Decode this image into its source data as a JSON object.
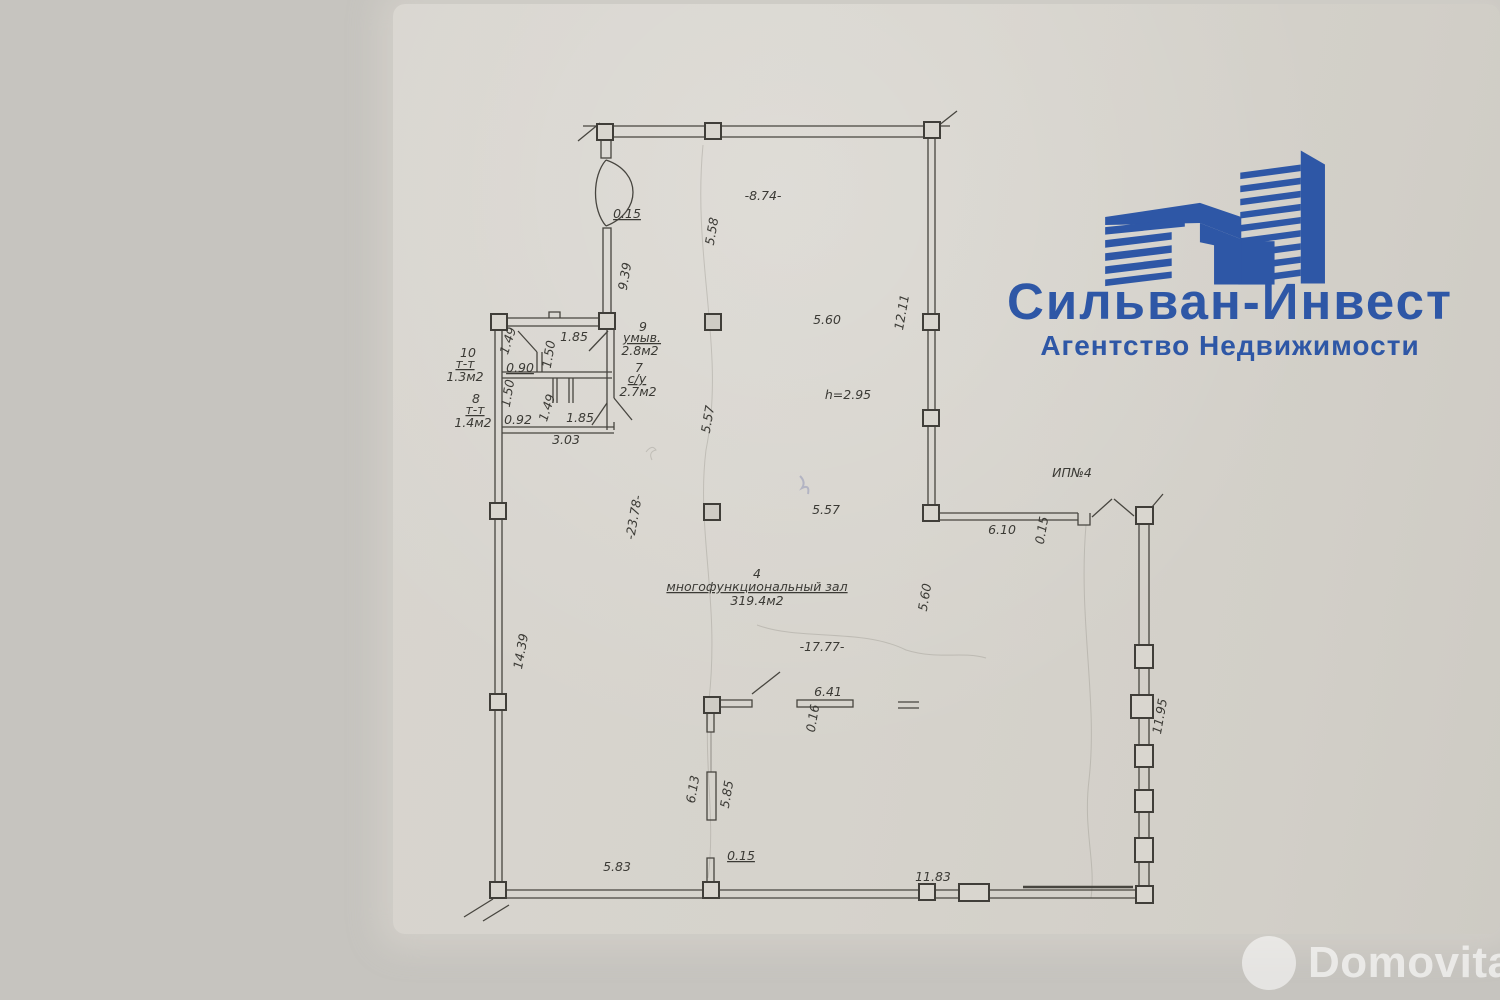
{
  "logo": {
    "title": "Сильван-Инвест",
    "subtitle": "Агентство Недвижимости",
    "color": "#2e57a6"
  },
  "watermark": {
    "text": "Domovita"
  },
  "colors": {
    "background": "#c6c4bf",
    "paper": "#d6d3cc",
    "line": "#47453f",
    "logo_blue": "#2e57a6"
  },
  "plan": {
    "summary": {
      "hall": {
        "number": "4",
        "name": "многофункциональный зал",
        "area": "319.4м2",
        "ceiling_height": "h=2.95"
      },
      "rooms": [
        {
          "number": "7",
          "name": "с/у",
          "area": "2.7м2"
        },
        {
          "number": "8",
          "name": "т-т",
          "area": "1.4м2"
        },
        {
          "number": "9",
          "name": "умыв.",
          "area": "2.8м2"
        },
        {
          "number": "10",
          "name": "т-т",
          "area": "1.3м2"
        }
      ],
      "entrance_label": "ИП№4"
    },
    "labels": [
      {
        "t": "0.15",
        "x": 627,
        "y": 218,
        "u": 1
      },
      {
        "t": "9.39",
        "x": 629,
        "y": 277,
        "r": -80
      },
      {
        "t": "5.58",
        "x": 716,
        "y": 232,
        "r": -80
      },
      {
        "t": "-8.74-",
        "x": 763,
        "y": 200
      },
      {
        "t": "12.11",
        "x": 906,
        "y": 313,
        "r": -80
      },
      {
        "t": "5.60",
        "x": 827,
        "y": 324
      },
      {
        "t": "1.49",
        "x": 512,
        "y": 342,
        "r": -72
      },
      {
        "t": "1.85",
        "x": 574,
        "y": 341
      },
      {
        "t": "1.50",
        "x": 553,
        "y": 355,
        "r": -80
      },
      {
        "t": "9",
        "x": 643,
        "y": 331
      },
      {
        "t": "умыв.",
        "x": 642,
        "y": 342,
        "u": 1
      },
      {
        "t": "2.8м2",
        "x": 640,
        "y": 355
      },
      {
        "t": "10",
        "x": 468,
        "y": 357
      },
      {
        "t": "т-т",
        "x": 465,
        "y": 368,
        "u": 1
      },
      {
        "t": "1.3м2",
        "x": 465,
        "y": 381
      },
      {
        "t": "0.90",
        "x": 520,
        "y": 372,
        "u": 1
      },
      {
        "t": "7",
        "x": 639,
        "y": 372
      },
      {
        "t": "с/у",
        "x": 637,
        "y": 383,
        "u": 1
      },
      {
        "t": "2.7м2",
        "x": 638,
        "y": 396
      },
      {
        "t": "1.50",
        "x": 512,
        "y": 394,
        "r": -80
      },
      {
        "t": "1.49",
        "x": 551,
        "y": 409,
        "r": -72
      },
      {
        "t": "8",
        "x": 476,
        "y": 403
      },
      {
        "t": "т-т",
        "x": 475,
        "y": 414,
        "u": 1
      },
      {
        "t": "1.4м2",
        "x": 473,
        "y": 427
      },
      {
        "t": "0.92",
        "x": 518,
        "y": 424
      },
      {
        "t": "1.85",
        "x": 580,
        "y": 422
      },
      {
        "t": "3.03",
        "x": 566,
        "y": 444
      },
      {
        "t": "h=2.95",
        "x": 848,
        "y": 399
      },
      {
        "t": "5.57",
        "x": 712,
        "y": 420,
        "r": -80
      },
      {
        "t": "-23.78-",
        "x": 638,
        "y": 518,
        "r": -80
      },
      {
        "t": "5.57",
        "x": 826,
        "y": 514
      },
      {
        "t": "ИП№4",
        "x": 1072,
        "y": 477
      },
      {
        "t": "6.10",
        "x": 1002,
        "y": 534
      },
      {
        "t": "0.15",
        "x": 1046,
        "y": 531,
        "r": -80
      },
      {
        "t": "4",
        "x": 757,
        "y": 578
      },
      {
        "t": "многофункциональный зал",
        "x": 757,
        "y": 591,
        "u": 1
      },
      {
        "t": "319.4м2",
        "x": 757,
        "y": 605
      },
      {
        "t": "5.60",
        "x": 929,
        "y": 598,
        "r": -80
      },
      {
        "t": "14.39",
        "x": 525,
        "y": 652,
        "r": -80
      },
      {
        "t": "-17.77-",
        "x": 822,
        "y": 651
      },
      {
        "t": "6.41",
        "x": 828,
        "y": 696
      },
      {
        "t": "0.16",
        "x": 817,
        "y": 719,
        "r": -80
      },
      {
        "t": "11.95",
        "x": 1164,
        "y": 717,
        "r": -80
      },
      {
        "t": "6.13",
        "x": 697,
        "y": 790,
        "r": -80
      },
      {
        "t": "5.85",
        "x": 731,
        "y": 795,
        "r": -80
      },
      {
        "t": "5.83",
        "x": 617,
        "y": 871
      },
      {
        "t": "0.15",
        "x": 741,
        "y": 860,
        "u": 1
      },
      {
        "t": "11.83",
        "x": 933,
        "y": 881
      }
    ]
  }
}
